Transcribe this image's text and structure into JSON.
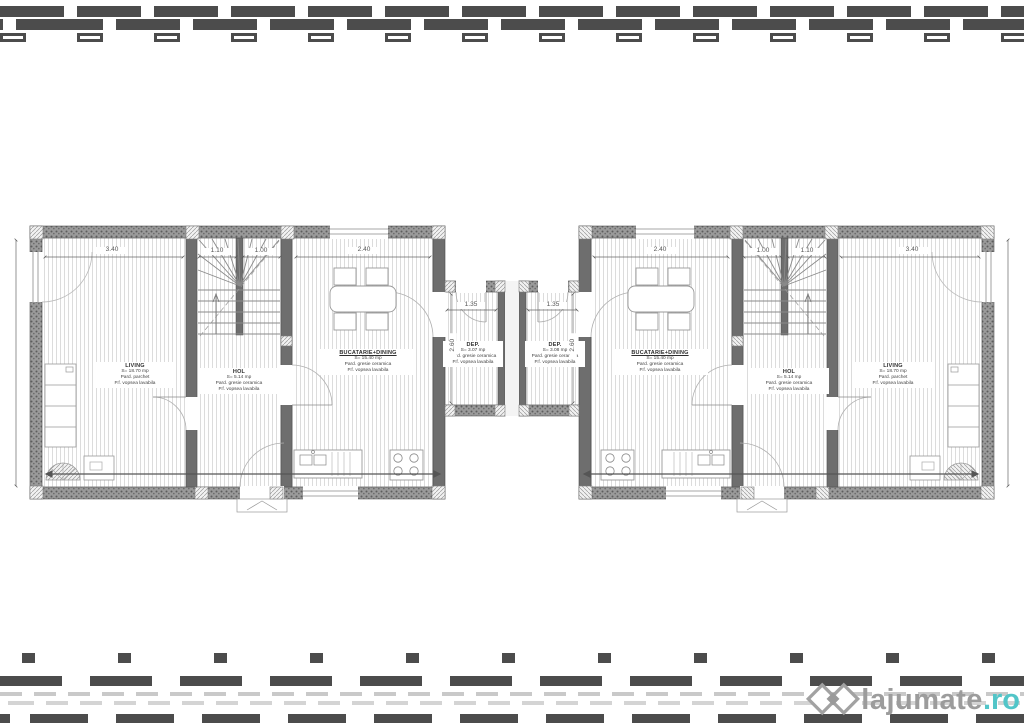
{
  "plan": {
    "rooms": {
      "left": {
        "living": {
          "name": "LIVING",
          "area": "S= 18.70 mp",
          "floor": "Pard. parchet",
          "finish": "P.f. vopsea lavabila"
        },
        "hall": {
          "name": "HOL",
          "area": "S= 5.14 mp",
          "floor": "Pard. gresie ceramica",
          "finish": "P.f. vopsea lavabila"
        },
        "kitchen": {
          "name": "BUCATARIE+DINING",
          "area": "S= 15.40 mp",
          "floor": "Pard. gresie ceramica",
          "finish": "P.f. vopsea lavabila"
        },
        "storage": {
          "name": "DEP.",
          "area": "S= 3.07 mp",
          "floor": "Pard. gresie ceramica",
          "finish": "P.f. vopsea lavabila"
        }
      },
      "right": {
        "living": {
          "name": "LIVING",
          "area": "S= 18.70 mp",
          "floor": "Pard. parchet",
          "finish": "P.f. vopsea lavabila"
        },
        "hall": {
          "name": "HOL",
          "area": "S= 5.14 mp",
          "floor": "Pard. gresie ceramica",
          "finish": "P.f. vopsea lavabila"
        },
        "kitchen": {
          "name": "BUCATARIE+DINING",
          "area": "S= 15.40 mp",
          "floor": "Pard. gresie ceramica",
          "finish": "P.f. vopsea lavabila"
        },
        "storage": {
          "name": "DEP.",
          "area": "S= 3.08 mp",
          "floor": "Pard. gresie ceramica",
          "finish": "P.f. vopsea lavabila"
        }
      }
    },
    "dimensions": {
      "living_width": "3.40",
      "stair_flight1": "1.10",
      "stair_flight2": "1.00",
      "kitchen_width": "2.40",
      "porch_width": "1.35",
      "porch_depth": "2.60"
    }
  },
  "watermark": {
    "brand": "lajumate",
    "tld": ".ro",
    "ghost": "BA"
  }
}
